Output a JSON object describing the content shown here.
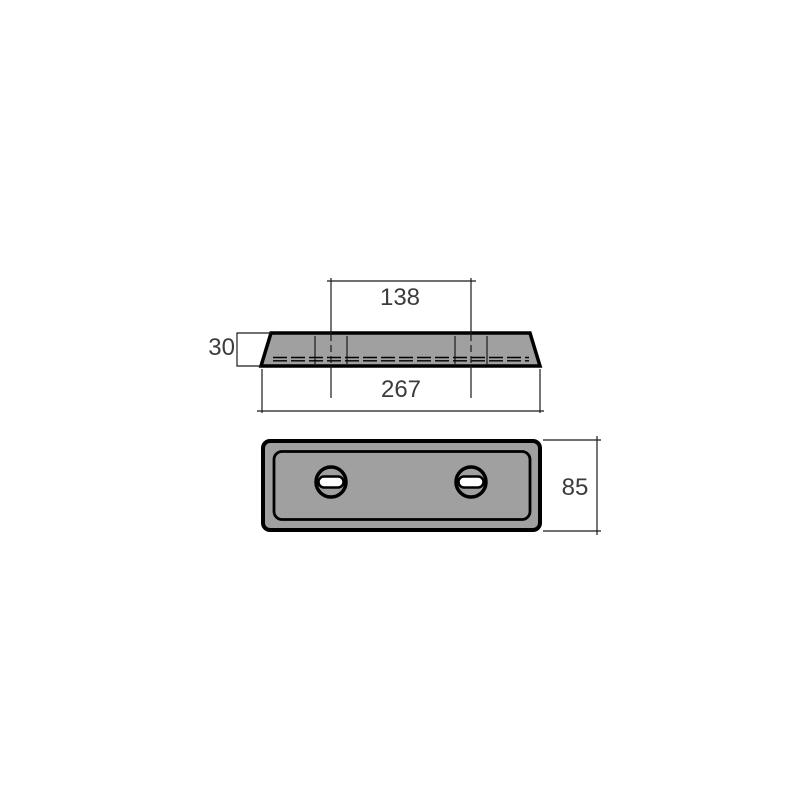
{
  "drawing": {
    "type": "technical-drawing-two-views",
    "views": {
      "side_view": {
        "dim_slot_spacing": "138",
        "dim_thickness": "30",
        "dim_overall_length": "267"
      },
      "front_view": {
        "dim_height": "85"
      }
    },
    "colors": {
      "part_fill": "#a0a0a0",
      "outline": "#000000",
      "thin_line": "#1a1a1a",
      "text": "#3c3c3c",
      "slot_fill": "#ffffff",
      "background": "#ffffff"
    }
  }
}
